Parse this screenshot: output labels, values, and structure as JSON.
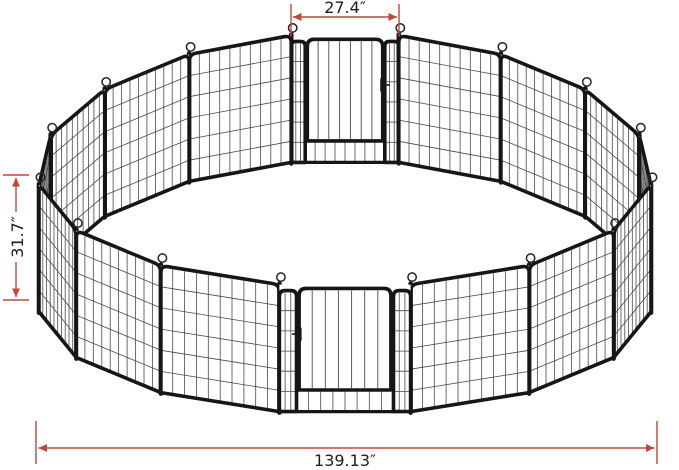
{
  "figure": {
    "colors": {
      "background": "#ffffff",
      "dimension_line": "#c4453f",
      "dimension_text": "#1d1d1d",
      "frame": "#161616",
      "wire": "#4a4a4a",
      "panel_fill": "#ffffff",
      "edge_panel_fill": "#e6e6e6",
      "hook": "#242424"
    },
    "dimensions": {
      "top_gate_width": {
        "label": "27.4″"
      },
      "panel_height": {
        "label": "31.7″"
      },
      "overall_width": {
        "label": "139.13″"
      }
    },
    "pen": {
      "panel_count": 16,
      "gate_count": 2,
      "gate_panel_indices": [
        3,
        11
      ],
      "vertical_wires_per_panel": 9,
      "horizontal_wires_per_panel": 5,
      "door_bars": 6
    }
  }
}
